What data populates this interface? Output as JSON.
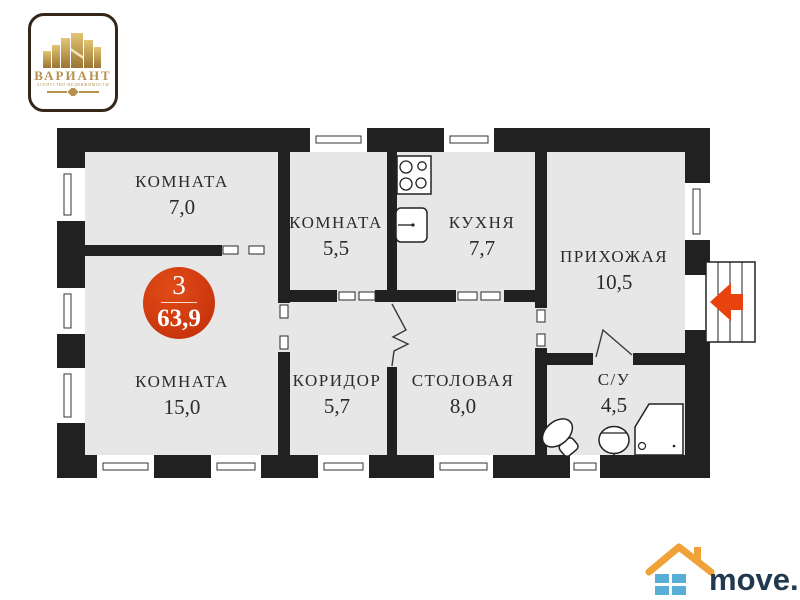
{
  "agency_logo": {
    "title": "ВАРИАНТ",
    "subtitle": "АГЕНТСТВО НЕДВИЖИМОСТИ"
  },
  "badge": {
    "rooms_count": "3",
    "total_area": "63,9"
  },
  "rooms": [
    {
      "name": "КОМНАТА",
      "area": "7,0"
    },
    {
      "name": "КОМНАТА",
      "area": "5,5"
    },
    {
      "name": "КУХНЯ",
      "area": "7,7"
    },
    {
      "name": "ПРИХОЖАЯ",
      "area": "10,5"
    },
    {
      "name": "КОМНАТА",
      "area": "15,0"
    },
    {
      "name": "КОРИДОР",
      "area": "5,7"
    },
    {
      "name": "СТОЛОВАЯ",
      "area": "8,0"
    },
    {
      "name": "С/У",
      "area": "4,5"
    }
  ],
  "watermark": {
    "site_name": "move.ru"
  },
  "colors": {
    "wall": "#212121",
    "room_fill": "#e8e7e7",
    "badge_red": "#d03a0f",
    "entrance_arrow": "#e8430e",
    "logo_gold": "#b5914f",
    "site_text": "#20394f",
    "site_roof": "#f0a238",
    "site_squares": "#58aed5"
  }
}
